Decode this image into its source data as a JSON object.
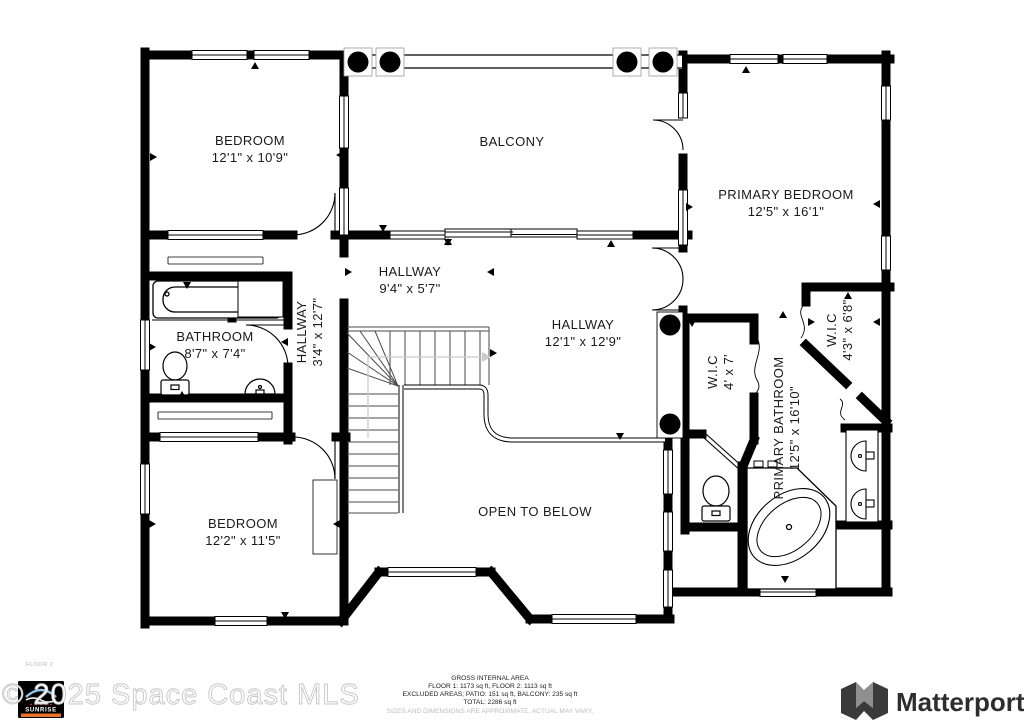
{
  "rooms": {
    "bedroom1": {
      "name": "BEDROOM",
      "dims": "12'1\" x 10'9\""
    },
    "balcony": {
      "name": "BALCONY"
    },
    "primary_bedroom": {
      "name": "PRIMARY BEDROOM",
      "dims": "12'5\" x 16'1\""
    },
    "hallway_top": {
      "name": "HALLWAY",
      "dims": "9'4\" x 5'7\""
    },
    "hallway_left": {
      "name": "HALLWAY",
      "dims": "3'4\" x 12'7\""
    },
    "hallway_main": {
      "name": "HALLWAY",
      "dims": "12'1\" x 12'9\""
    },
    "bathroom": {
      "name": "BATHROOM",
      "dims": "8'7\" x 7'4\""
    },
    "wic_small": {
      "name": "W.I.C",
      "dims": "4' x 7'"
    },
    "wic_large": {
      "name": "W.I.C",
      "dims": "4'3\" x 6'8\""
    },
    "primary_bathroom": {
      "name": "PRIMARY BATHROOM",
      "dims": "12'5\" x 16'10\""
    },
    "bedroom2": {
      "name": "BEDROOM",
      "dims": "12'2\" x 11'5\""
    },
    "open_below": {
      "name": "OPEN TO BELOW"
    }
  },
  "footer": {
    "floor_label": "FLOOR 2",
    "watermark": "© 2025 Space Coast MLS",
    "mls_logo": "SUNRISE",
    "area_title": "GROSS INTERNAL AREA",
    "area_line1": "FLOOR 1: 1173 sq ft, FLOOR 2: 1113 sq ft",
    "area_line2": "EXCLUDED AREAS; PATIO: 151 sq ft, BALCONY: 235 sq ft",
    "area_line3": "TOTAL: 2286 sq ft",
    "disclaimer": "SIZES AND DIMENSIONS ARE APPROXIMATE, ACTUAL MAY VARY.",
    "brand": "Matterport"
  },
  "colors": {
    "wall": "#000000",
    "background": "#ffffff",
    "label": "#1a1a1a",
    "watermark_outline": "#c6c6c6",
    "sunrise_orange": "#e8722a",
    "sunrise_blue": "#8ec6e6"
  }
}
